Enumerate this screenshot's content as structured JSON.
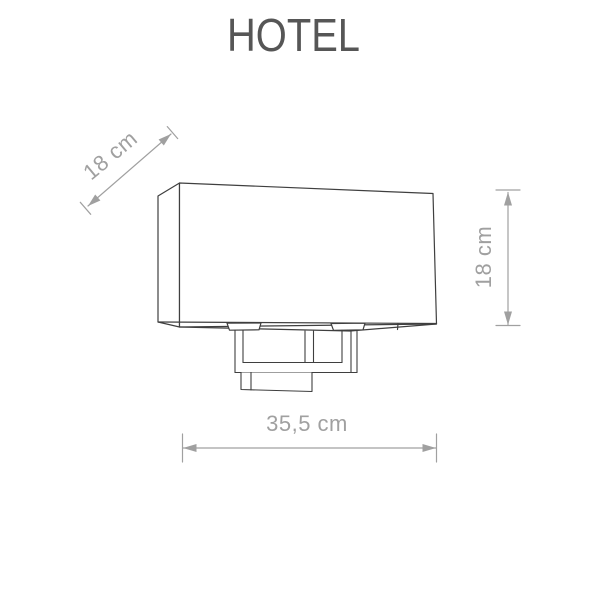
{
  "title": "HOTEL",
  "dimensions": {
    "depth": {
      "label": "18 cm"
    },
    "height": {
      "label": "18 cm"
    },
    "width": {
      "label": "35,5 cm"
    }
  },
  "colors": {
    "background": "#ffffff",
    "outline": "#3f3f3f",
    "dimension": "#a0a0a0",
    "title": "#565656"
  }
}
